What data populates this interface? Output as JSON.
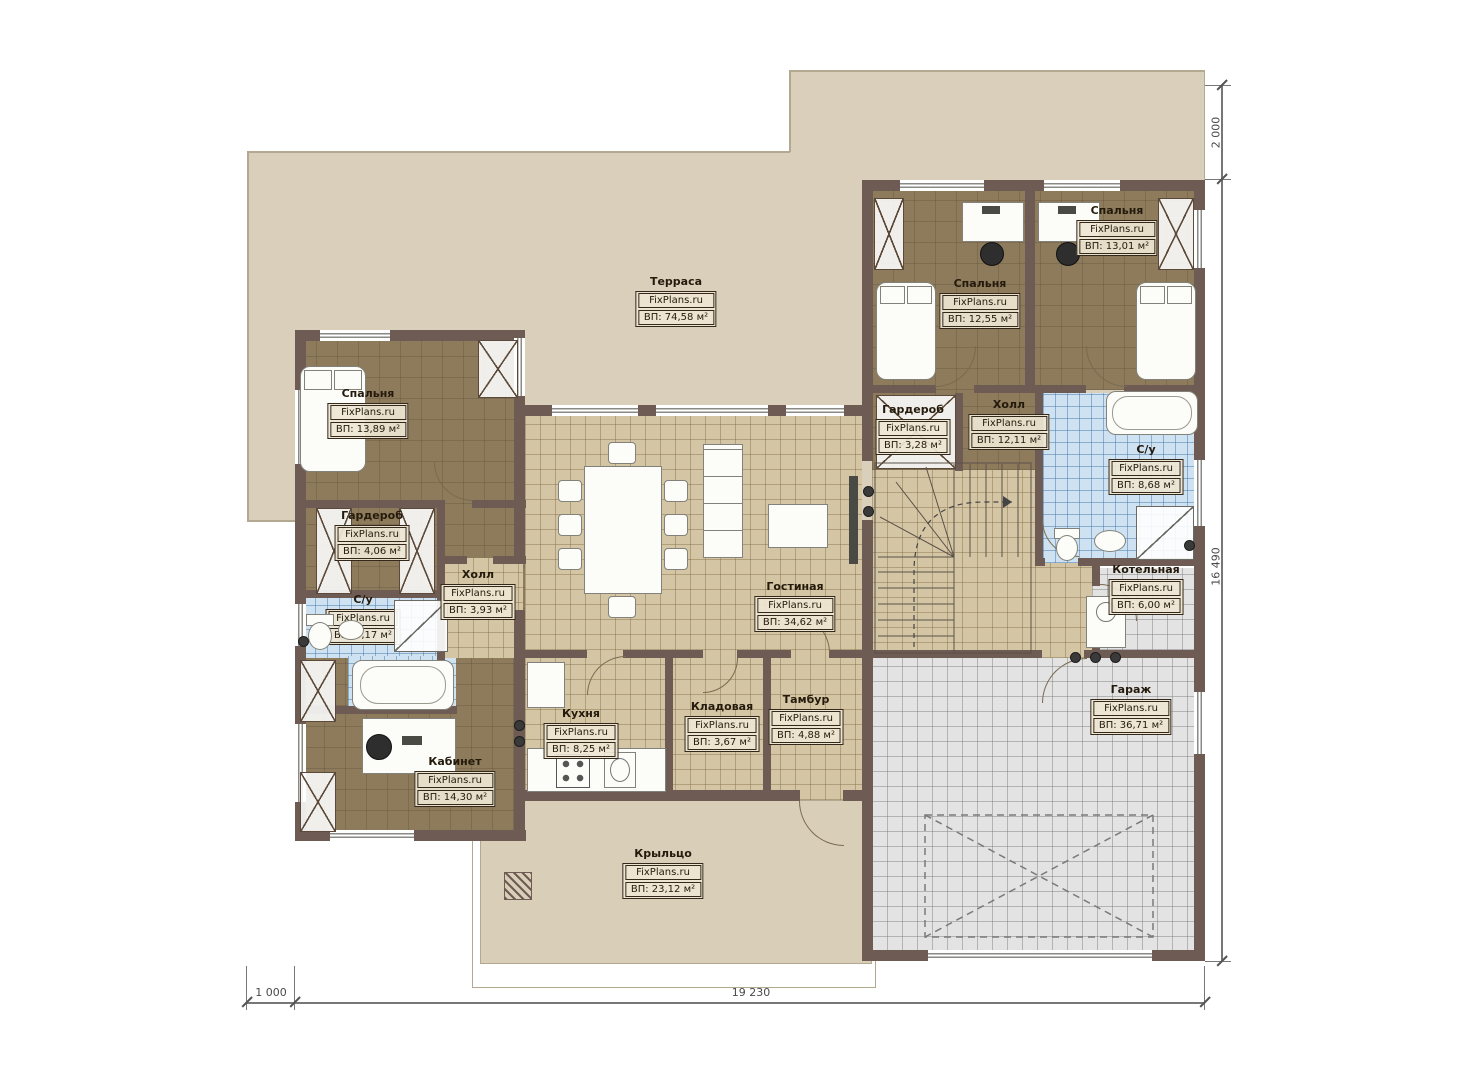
{
  "plan": {
    "brand": "FixPlans.ru",
    "rooms": [
      {
        "id": "terrace",
        "name": "Терраса",
        "area": "ВП: 74,58 м²"
      },
      {
        "id": "bedroom-right",
        "name": "Спальня",
        "area": "ВП: 13,01 м²"
      },
      {
        "id": "bedroom-mid",
        "name": "Спальня",
        "area": "ВП: 12,55 м²"
      },
      {
        "id": "bedroom-left",
        "name": "Спальня",
        "area": "ВП: 13,89 м²"
      },
      {
        "id": "wardrobe-left",
        "name": "Гардероб",
        "area": "ВП: 4,06 м²"
      },
      {
        "id": "wardrobe-right",
        "name": "Гардероб",
        "area": "ВП: 3,28 м²"
      },
      {
        "id": "hall-right",
        "name": "Холл",
        "area": "ВП: 12,11 м²"
      },
      {
        "id": "bath-right",
        "name": "С/у",
        "area": "ВП: 8,68 м²"
      },
      {
        "id": "hall-left",
        "name": "Холл",
        "area": "ВП: 3,93 м²"
      },
      {
        "id": "bath-left",
        "name": "С/у",
        "area": "ВП: 5,17 м²"
      },
      {
        "id": "living",
        "name": "Гостиная",
        "area": "ВП: 34,62 м²"
      },
      {
        "id": "boiler",
        "name": "Котельная",
        "area": "ВП: 6,00 м²"
      },
      {
        "id": "kitchen",
        "name": "Кухня",
        "area": "ВП: 8,25 м²"
      },
      {
        "id": "storage",
        "name": "Кладовая",
        "area": "ВП: 3,67 м²"
      },
      {
        "id": "vestibule",
        "name": "Тамбур",
        "area": "ВП: 4,88 м²"
      },
      {
        "id": "garage",
        "name": "Гараж",
        "area": "ВП: 36,71 м²"
      },
      {
        "id": "office",
        "name": "Кабинет",
        "area": "ВП: 14,30 м²"
      },
      {
        "id": "porch",
        "name": "Крыльцо",
        "area": "ВП: 23,12 м²"
      }
    ],
    "dimensions": {
      "right_top": "2 000",
      "right_side": "16 490",
      "bottom_left": "1 000",
      "bottom_width": "19 230"
    },
    "colors": {
      "wall": "#6e5b54",
      "terrace": "#dacfba",
      "floor_tile": "#d4c6a4",
      "floor_wood": "#8d7b5c",
      "bath_tile": "#cfe2f2",
      "garage_tile": "#e3e3e3",
      "label_border": "#33281a",
      "dimension": "#555555"
    }
  }
}
